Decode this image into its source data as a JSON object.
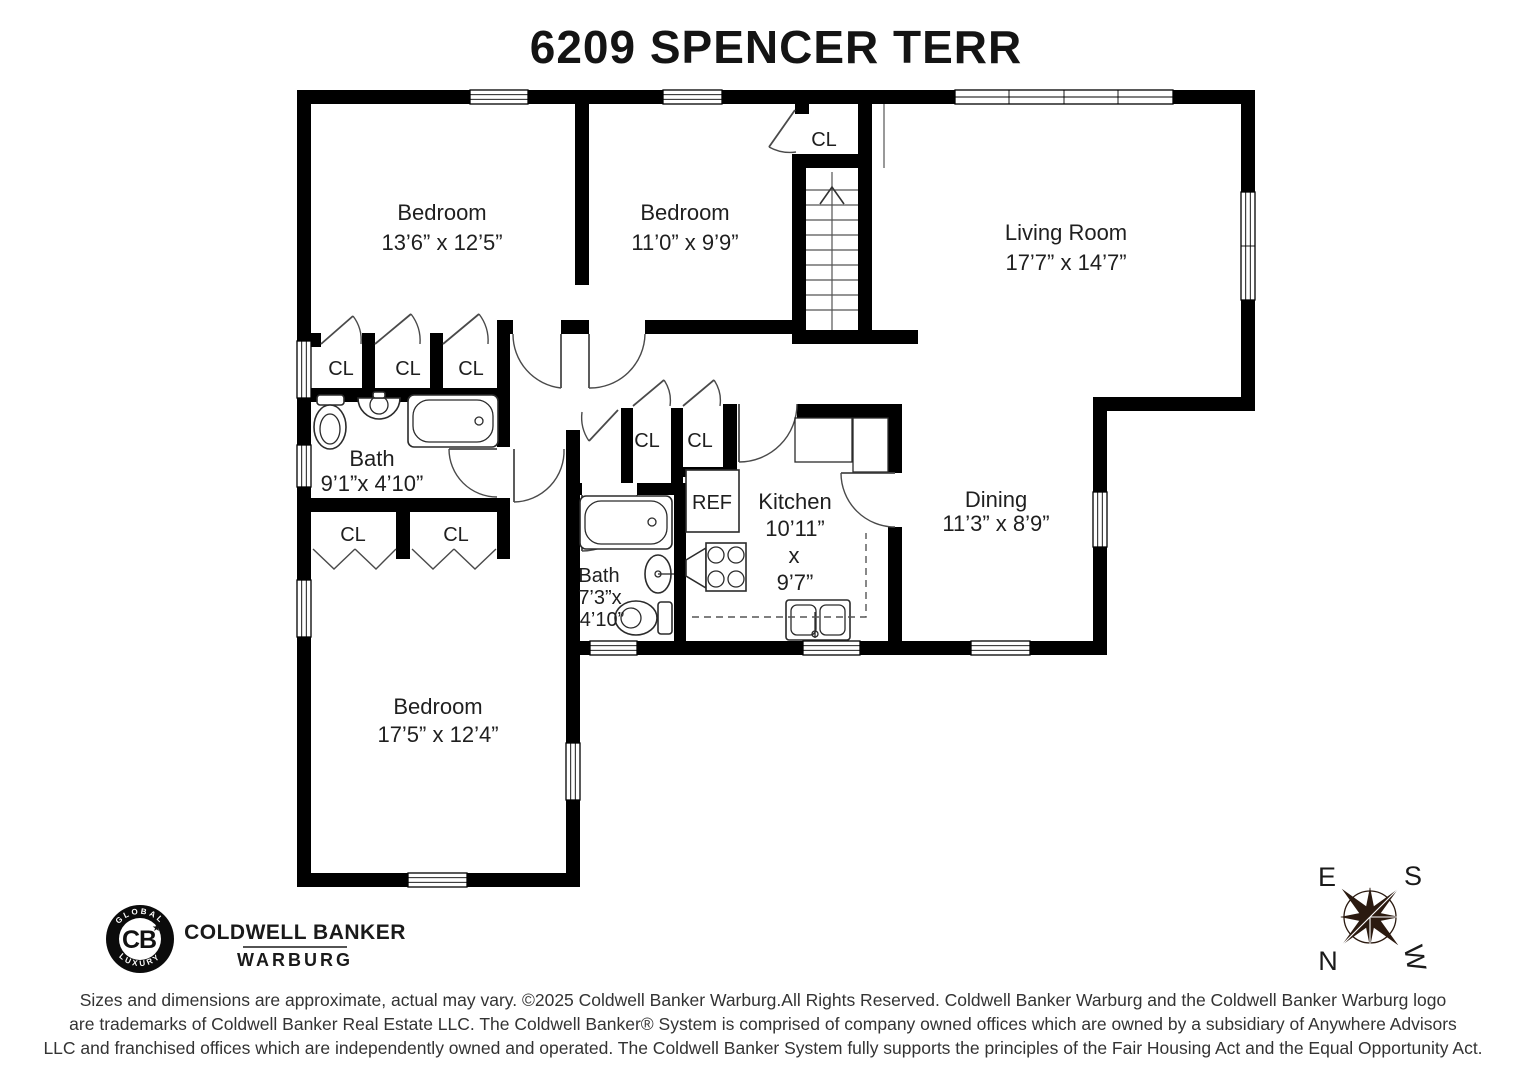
{
  "title": "6209 SPENCER TERR",
  "rooms": {
    "bedroom1": {
      "name": "Bedroom",
      "dims": "13’6” x 12’5”"
    },
    "bedroom2": {
      "name": "Bedroom",
      "dims": "11’0” x 9’9”"
    },
    "living": {
      "name": "Living Room",
      "dims": "17’7” x 14’7”"
    },
    "dining": {
      "name": "Dining",
      "dims": "11’3” x 8’9”"
    },
    "kitchen": {
      "name": "Kitchen",
      "dim1": "10’11”",
      "dim2": "x",
      "dim3": "9’7”"
    },
    "bath1": {
      "name": "Bath",
      "dims": "9’1”x 4’10”"
    },
    "bath2": {
      "name": "Bath",
      "dim1": "7’3”x",
      "dim2": "4’10”"
    },
    "bedroom3": {
      "name": "Bedroom",
      "dims": "17’5” x 12’4”"
    }
  },
  "labels": {
    "closet": "CL",
    "fridge": "REF"
  },
  "compass": {
    "e": "E",
    "s": "S",
    "n": "N",
    "w": "W"
  },
  "branding": {
    "seal_top": "GLOBAL",
    "seal_bottom": "LUXURY",
    "monogram": "CB",
    "star": "★",
    "name_line1": "COLDWELL BANKER",
    "name_line2": "WARBURG"
  },
  "disclaimer": {
    "line1": "Sizes and dimensions are approximate, actual may vary. ©2025 Coldwell Banker Warburg.All Rights Reserved. Coldwell Banker Warburg and the Coldwell Banker Warburg logo",
    "line2": "are trademarks of Coldwell Banker Real Estate LLC. The Coldwell Banker® System is comprised of company owned offices which are owned by a subsidiary of Anywhere Advisors",
    "line3": "LLC and franchised offices which are independently owned and operated. The Coldwell Banker System fully supports the principles of the Fair Housing Act and the Equal Opportunity Act."
  },
  "colors": {
    "wall": "#000000",
    "text": "#1f1f1f",
    "compass": "#2b1a10"
  }
}
